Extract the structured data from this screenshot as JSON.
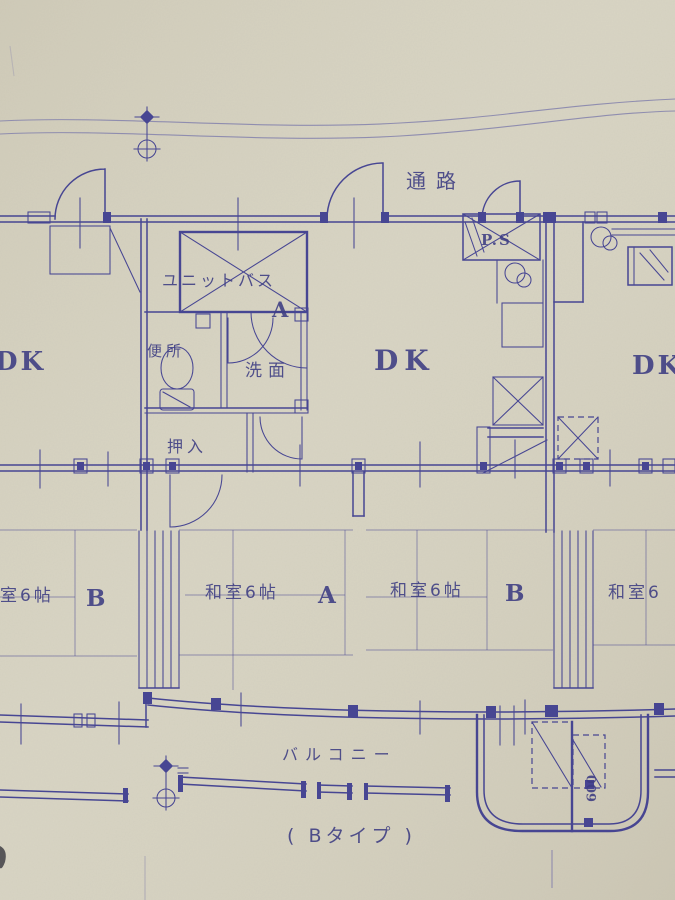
{
  "document": {
    "kind": "scanned-apartment-floor-plan",
    "plan_variant_caption": "( Bタイプ )"
  },
  "colors": {
    "paper": "#d7d3c1",
    "ink": "#3d3c90",
    "ink_faint": "#8a88ae",
    "text": "#32327e"
  },
  "labels": {
    "corridor": "通路",
    "pipe_space": "P.S",
    "unit_bath": "ユニットバス",
    "door_mark": "A",
    "toilet": "便所",
    "washroom": "洗面",
    "closet": "押入",
    "dk_left": "DK",
    "dk_center": "DK",
    "dk_right": "DK",
    "balcony": "バルコニー",
    "plan_type": "( Bタイプ )",
    "stair_width": "600"
  },
  "rooms": [
    {
      "id": "left-unit-tatami",
      "name": "室6帖",
      "letter": "B"
    },
    {
      "id": "tatami-a",
      "name": "和室6帖",
      "letter": "A"
    },
    {
      "id": "tatami-b",
      "name": "和室6帖",
      "letter": "B"
    },
    {
      "id": "right-unit-tatami",
      "name": "和室6",
      "letter": ""
    }
  ]
}
